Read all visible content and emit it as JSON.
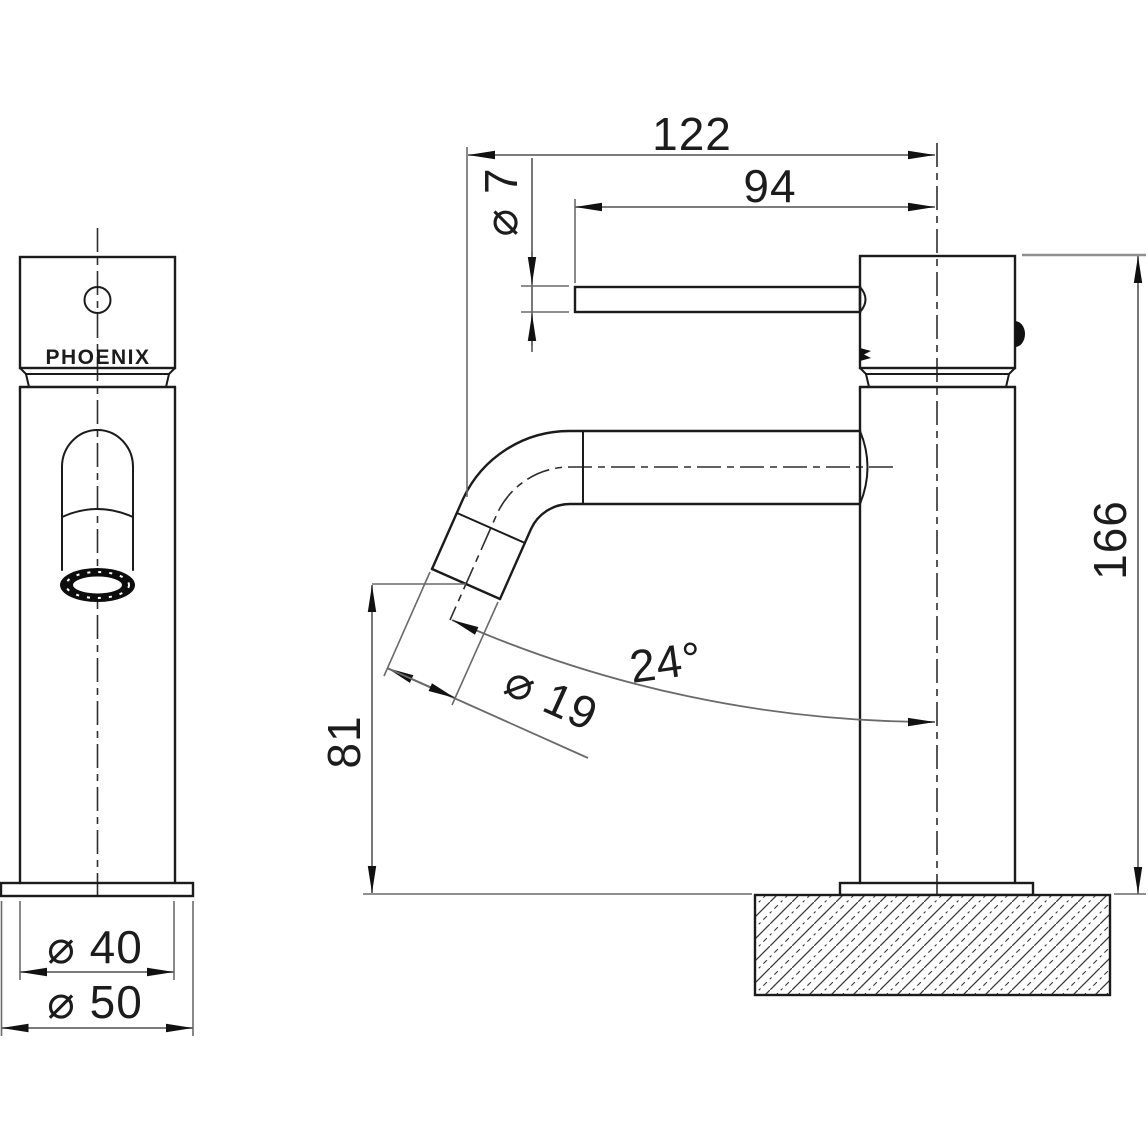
{
  "drawing": {
    "brand_label": "PHOENIX"
  },
  "dimensions": {
    "projection_overall": {
      "label": "122"
    },
    "lever_length": {
      "label": "94"
    },
    "lever_diameter": {
      "label": "⌀ 7"
    },
    "spout_diameter": {
      "label": "⌀ 19"
    },
    "spout_angle": {
      "label": "24°"
    },
    "outlet_height": {
      "label": "81"
    },
    "overall_height": {
      "label": "166"
    },
    "body_diameter": {
      "label": "⌀ 40"
    },
    "base_diameter": {
      "label": "⌀ 50"
    }
  },
  "colors": {
    "outline": "#1b1b1b",
    "dimension_lines": "#6a6a6a",
    "background": "#ffffff"
  }
}
